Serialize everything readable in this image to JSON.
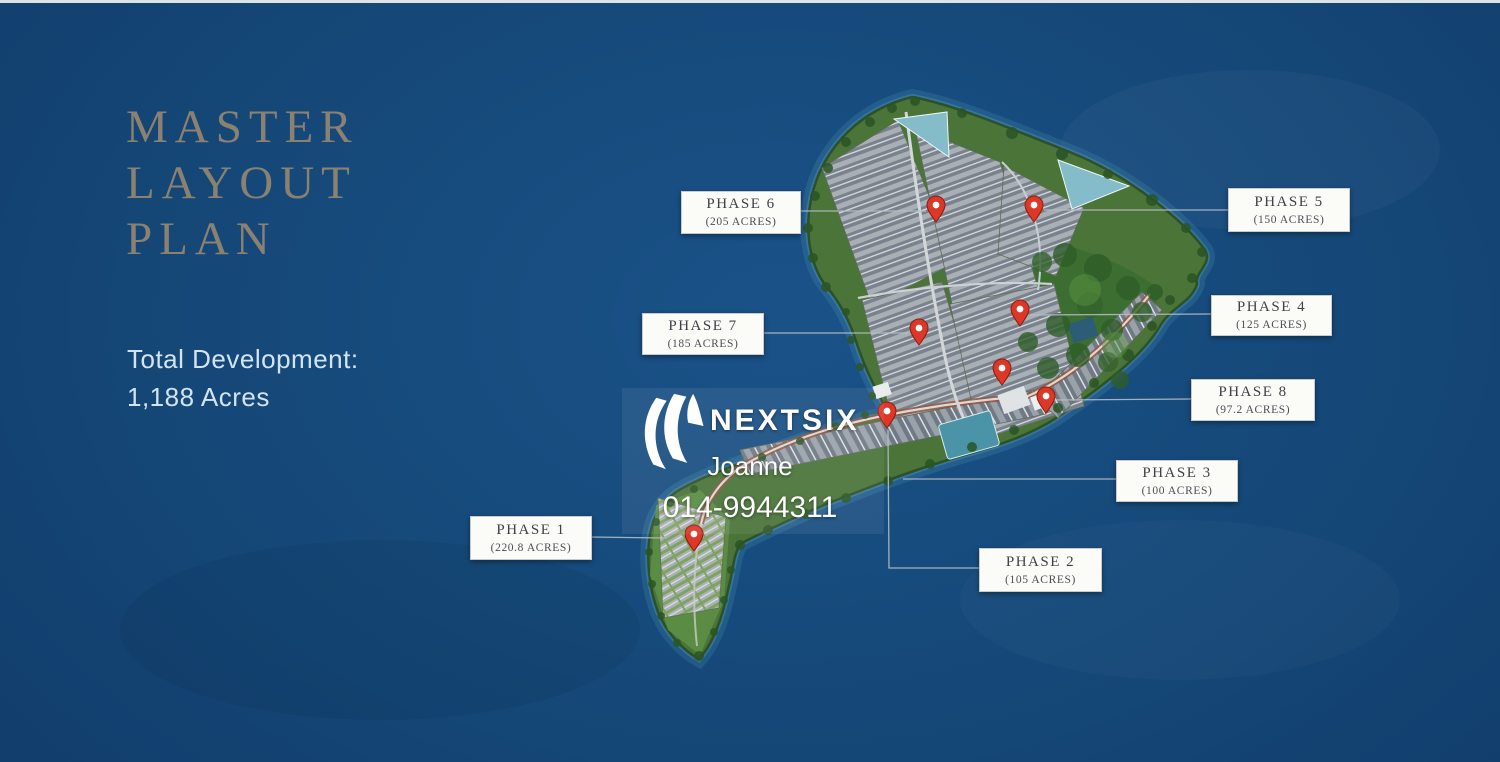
{
  "page": {
    "description": "Master layout plan marketing slide of an industrial development on a coastal land parcel",
    "colors": {
      "background": "#144678",
      "title_text": "#8a8171",
      "body_text": "#d2e4f1",
      "phase_label_text": "#3e4248",
      "phase_box_background": "#fbfbf8",
      "pin": "#dc3727",
      "island_green": "#4a7438",
      "pond_teal": "#84bcca"
    }
  },
  "title": {
    "lines": [
      "MASTER",
      "LAYOUT",
      "PLAN"
    ]
  },
  "total_development": {
    "label": "Total Development:",
    "value": "1,188 Acres"
  },
  "phases": [
    {
      "name": "PHASE 1",
      "acreage": "(220.8 ACRES)"
    },
    {
      "name": "PHASE 2",
      "acreage": "(105 ACRES)"
    },
    {
      "name": "PHASE 3",
      "acreage": "(100 ACRES)"
    },
    {
      "name": "PHASE 4",
      "acreage": "(125 ACRES)"
    },
    {
      "name": "PHASE 5",
      "acreage": "(150 ACRES)"
    },
    {
      "name": "PHASE 6",
      "acreage": "(205 ACRES)"
    },
    {
      "name": "PHASE 7",
      "acreage": "(185 ACRES)"
    },
    {
      "name": "PHASE 8",
      "acreage": "(97.2 ACRES)"
    }
  ],
  "watermark": {
    "brand": "NEXTSIX",
    "agent": "Joanne",
    "phone": "014-9944311"
  }
}
